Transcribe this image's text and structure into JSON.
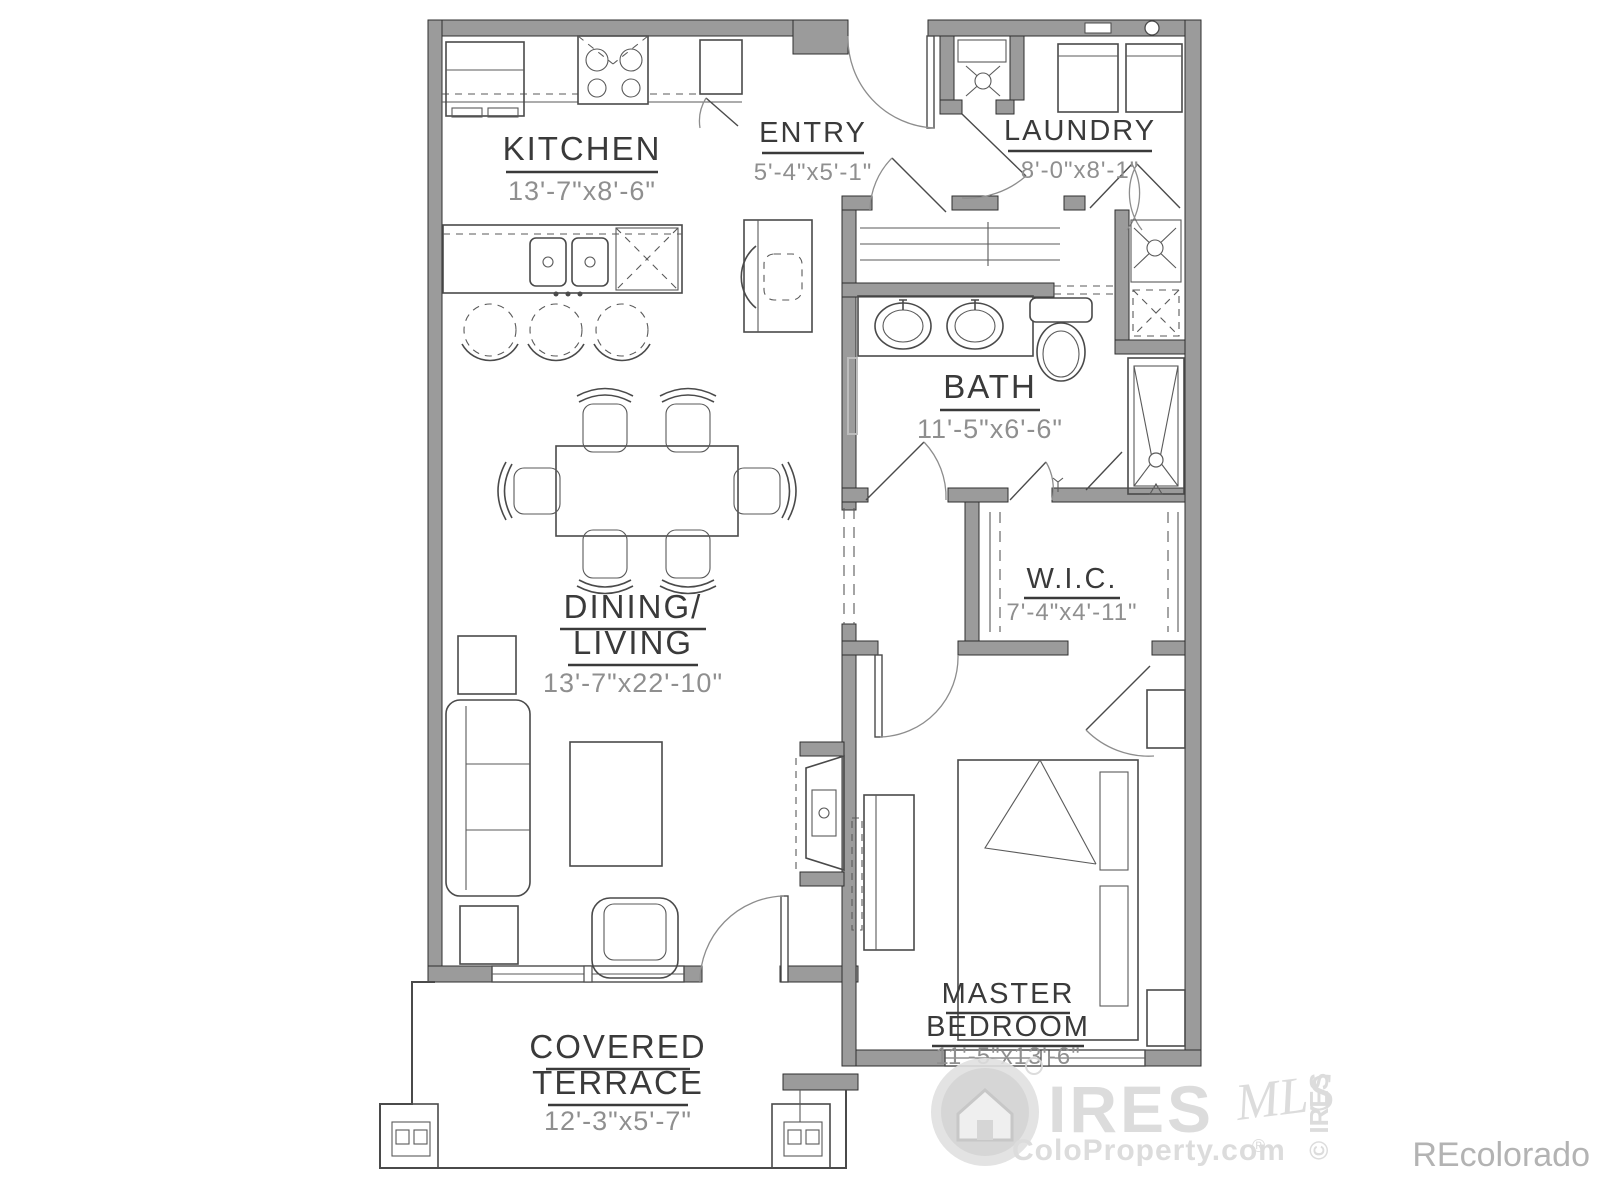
{
  "page": {
    "background": "#ffffff"
  },
  "colors": {
    "wall_gray": "#9b9b9b",
    "line_gray": "#4a4a4a",
    "label_color": "#3a3a3a",
    "dim_color": "#8f8f8f",
    "watermark_light": "#d9d9d9",
    "watermark_corner": "#ababab"
  },
  "rooms": {
    "kitchen": {
      "name": "KITCHEN",
      "dim": "13'-7\"x8'-6\""
    },
    "entry": {
      "name": "ENTRY",
      "dim": "5'-4\"x5'-1\""
    },
    "laundry": {
      "name": "LAUNDRY",
      "dim": "8'-0\"x8'-1\""
    },
    "bath": {
      "name": "BATH",
      "dim": "11'-5\"x6'-6\""
    },
    "wic": {
      "name": "W.I.C.",
      "dim": "7'-4\"x4'-11\""
    },
    "dining_living": {
      "name1": "DINING/",
      "name2": "LIVING",
      "dim": "13'-7\"x22'-10\""
    },
    "master": {
      "name1": "MASTER",
      "name2": "BEDROOM",
      "dim": "11'-5\"x13'-6\""
    },
    "terrace": {
      "name1": "COVERED",
      "name2": "TERRACE",
      "dim": "12'-3\"x5'-7\""
    }
  },
  "watermark": {
    "brand": "IRES",
    "script": "MLS",
    "site": "ColoProperty.com",
    "reg": "®",
    "copyright": "© IRES",
    "corner": "REcolorado"
  }
}
